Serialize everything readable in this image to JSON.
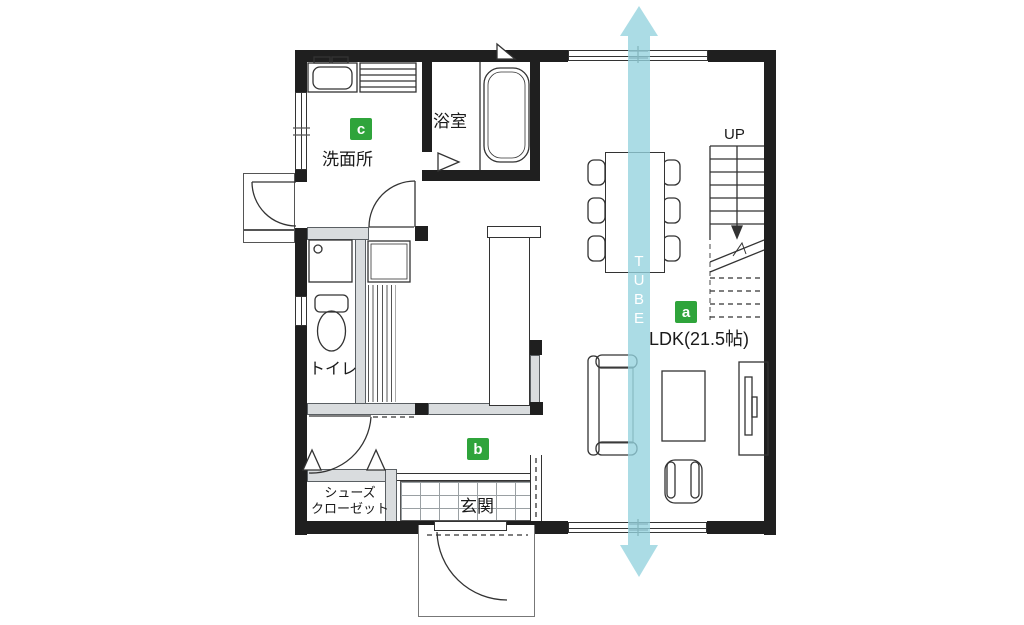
{
  "title": "1F floor plan",
  "colors": {
    "wall": "#1f1f1f",
    "partition_wall": "#d9dcde",
    "marker_green": "#2fa43b",
    "tube_arrow_blue": "#94d2de",
    "text": "#1a1a1a"
  },
  "labels": {
    "bathroom": "浴室",
    "washroom": "洗面所",
    "toilet": "トイレ",
    "entrance": "玄関",
    "shoe_closet_1": "シューズ",
    "shoe_closet_2": "クローゼット",
    "ldk": "LDK(21.5帖)",
    "up": "UP"
  },
  "markers": {
    "a": "a",
    "b": "b",
    "c": "c"
  },
  "tube": [
    "T",
    "U",
    "B",
    "E"
  ]
}
